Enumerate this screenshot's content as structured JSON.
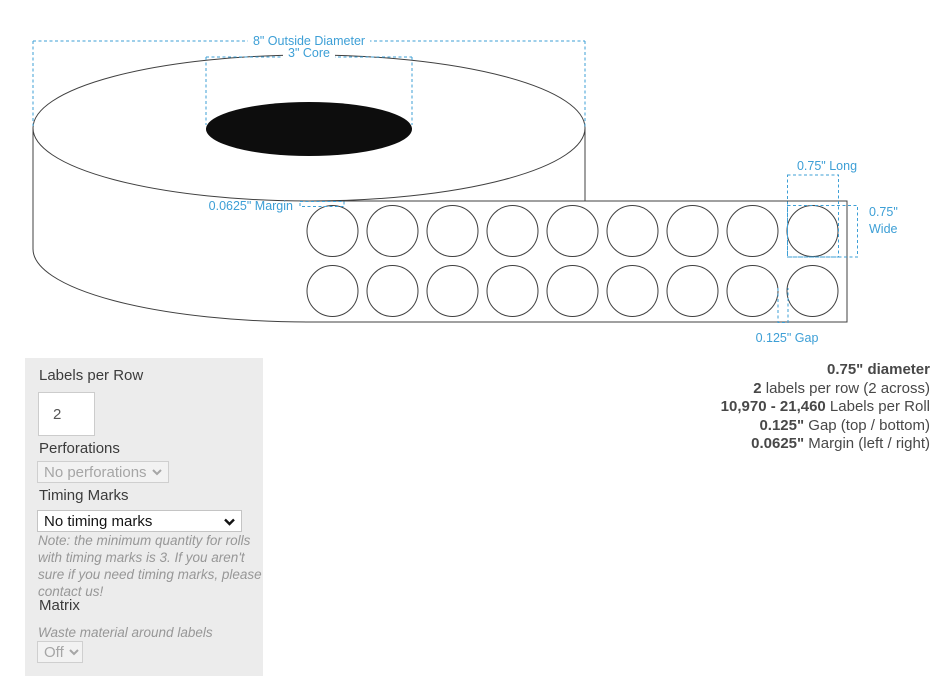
{
  "colors": {
    "accent": "#3d9fd6",
    "panel_bg": "#ececec",
    "line": "#404040"
  },
  "diagram": {
    "annotations": {
      "outside_diameter": "8\" Outside Diameter",
      "core": "3\" Core",
      "margin": "0.0625\" Margin",
      "long": "0.75\" Long",
      "wide": "0.75\" Wide",
      "gap": "0.125\" Gap"
    },
    "labels": {
      "rows": 2,
      "columns": 9
    }
  },
  "controls": {
    "labels_per_row": {
      "label": "Labels per Row",
      "value": "2"
    },
    "perforations": {
      "label": "Perforations",
      "value": "No perforations"
    },
    "timing_marks": {
      "label": "Timing Marks",
      "value": "No timing marks",
      "note": "Note: the minimum quantity for rolls with timing marks is 3. If you aren't sure if you need timing marks, please contact us!"
    },
    "matrix": {
      "label": "Matrix",
      "description": "Waste material around labels",
      "value": "Off"
    }
  },
  "summary": {
    "lines": [
      {
        "bold": "0.75\" diameter",
        "rest": ""
      },
      {
        "bold": "2",
        "rest": " labels per row (2 across)"
      },
      {
        "bold": "10,970 - 21,460",
        "rest": " Labels per Roll"
      },
      {
        "bold": "0.125\"",
        "rest": " Gap (top / bottom)"
      },
      {
        "bold": "0.0625\"",
        "rest": " Margin (left / right)"
      }
    ]
  }
}
